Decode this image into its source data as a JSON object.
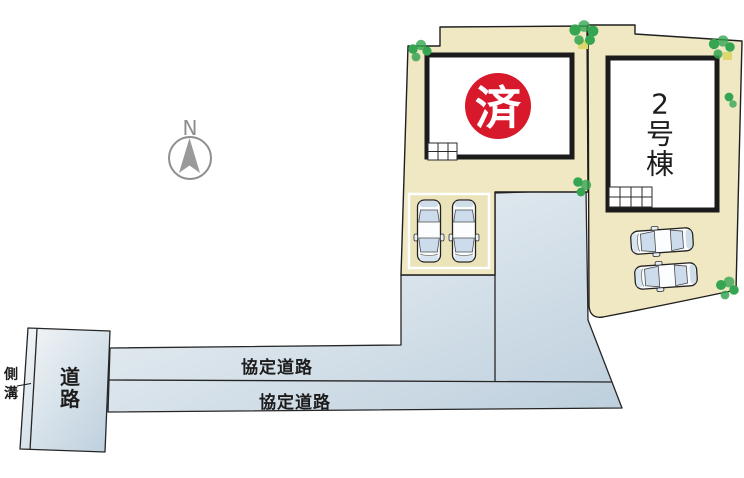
{
  "site_plan": {
    "description": "residential lot site plan",
    "compass": {
      "north_label": "N"
    },
    "plot1": {
      "stamp_label": "済",
      "stamp_status": "sold",
      "car_count": 2
    },
    "plot2": {
      "building_label": "2号棟",
      "building_label_chars": [
        "2",
        "号",
        "棟"
      ],
      "car_count": 2
    },
    "roads": {
      "agreement_road_labels": [
        "協定道路",
        "協定道路"
      ],
      "left_road_label": "道路",
      "left_road_label_chars": [
        "道",
        "路"
      ],
      "gutter_label": "側溝",
      "gutter_label_chars": [
        "側",
        "溝"
      ]
    },
    "colors": {
      "plot_fill": "#efe8c3",
      "road_fill_light": "#f3f6f8",
      "road_fill_dark": "#bdcfdd",
      "stamp_red": "#d8182b",
      "bush_green": "#35a552",
      "building_fill": "#ffffff",
      "outline": "#262626"
    }
  }
}
